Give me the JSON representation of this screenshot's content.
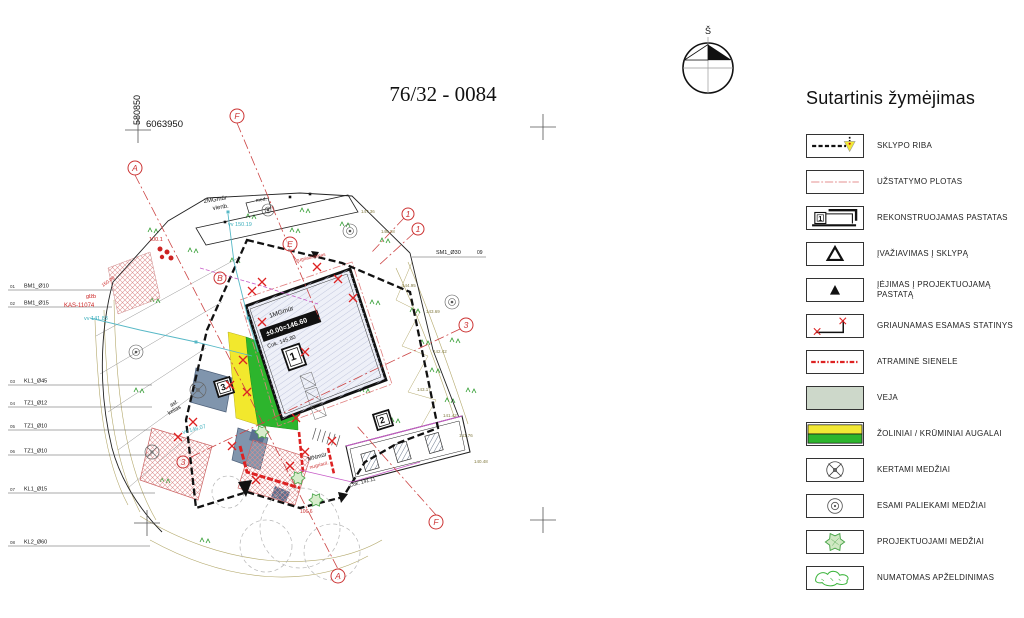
{
  "title": "76/32 - 0084",
  "compass": {
    "label": "Š"
  },
  "legend": {
    "heading": "Sutartinis žymėjimas",
    "items": [
      {
        "label": "SKLYPO RIBA",
        "symbol": "sklypo-riba"
      },
      {
        "label": "UŽSTATYMO PLOTAS",
        "symbol": "uzstatymo-plotas"
      },
      {
        "label": "REKONSTRUOJAMAS PASTATAS",
        "symbol": "rekonstruojamas-pastatas",
        "digit": "1"
      },
      {
        "label": "ĮVAŽIAVIMAS Į SKLYPĄ",
        "symbol": "ivaziavimas-i-sklypa"
      },
      {
        "label": "ĮĖJIMAS Į PROJEKTUOJAMĄ PASTATĄ",
        "symbol": "iejimas-i-pastata"
      },
      {
        "label": "GRIAUNAMAS ESAMAS STATINYS",
        "symbol": "griaunamas-statinys"
      },
      {
        "label": "ATRAMINĖ SIENELE",
        "symbol": "atramine-sienele"
      },
      {
        "label": "VEJA",
        "symbol": "veja"
      },
      {
        "label": "ŽOLINIAI / KRŪMINIAI AUGALAI",
        "symbol": "zoliniai-kruminiai"
      },
      {
        "label": "KERTAMI MEDŽIAI",
        "symbol": "kertami-medziai"
      },
      {
        "label": "ESAMI PALIEKAMI MEDŽIAI",
        "symbol": "esami-paliekami-medziai"
      },
      {
        "label": "PROJEKTUOJAMI MEDŽIAI",
        "symbol": "projektuojami-medziai"
      },
      {
        "label": "NUMATOMAS APŽELDINIMAS",
        "symbol": "numatomas-apzeldinimas"
      }
    ]
  },
  "plan": {
    "callouts": [
      {
        "no": "01",
        "label": "BM1_Ø10",
        "y": 290,
        "x1": 8,
        "x2": 114,
        "nx": 10,
        "lx": 24
      },
      {
        "no": "02",
        "label": "BM1_Ø15",
        "y": 307,
        "x1": 8,
        "x2": 112,
        "nx": 10,
        "lx": 24
      },
      {
        "no": "03",
        "label": "KL1_Ø45",
        "y": 385,
        "x1": 8,
        "x2": 152,
        "nx": 10,
        "lx": 24
      },
      {
        "no": "04",
        "label": "TZ1_Ø12",
        "y": 407,
        "x1": 8,
        "x2": 152,
        "nx": 10,
        "lx": 24
      },
      {
        "no": "05",
        "label": "TZ1_Ø10",
        "y": 430,
        "x1": 8,
        "x2": 152,
        "nx": 10,
        "lx": 24
      },
      {
        "no": "06",
        "label": "TZ1_Ø10",
        "y": 455,
        "x1": 8,
        "x2": 152,
        "nx": 10,
        "lx": 24
      },
      {
        "no": "07",
        "label": "KL1_Ø15",
        "y": 493,
        "x1": 8,
        "x2": 155,
        "nx": 10,
        "lx": 24
      },
      {
        "no": "08",
        "label": "KL2_Ø60",
        "y": 546,
        "x1": 8,
        "x2": 150,
        "nx": 10,
        "lx": 24
      }
    ],
    "labels": [
      {
        "t": "580850",
        "x": 140,
        "y": 110,
        "s": 9,
        "c": "#111",
        "r": -90,
        "a": "middle"
      },
      {
        "t": "6063950",
        "x": 146,
        "y": 127,
        "s": 9.5,
        "c": "#111"
      },
      {
        "t": "SM1_Ø30",
        "x": 436,
        "y": 254,
        "s": 5.5,
        "c": "#111"
      },
      {
        "t": "09",
        "x": 477,
        "y": 254,
        "s": 5,
        "c": "#111"
      },
      {
        "t": "2MGmūr",
        "x": 204,
        "y": 203,
        "s": 6,
        "c": "#111",
        "r": -9
      },
      {
        "t": "vienb.",
        "x": 213,
        "y": 210,
        "s": 6,
        "c": "#111",
        "r": -9
      },
      {
        "t": "med.",
        "x": 256,
        "y": 202,
        "s": 5,
        "c": "#111",
        "r": -9
      },
      {
        "t": "vv 150.19",
        "x": 228,
        "y": 226,
        "s": 5.5,
        "c": "#3aaebc"
      },
      {
        "t": "vv 141.83",
        "x": 84,
        "y": 320,
        "s": 5.5,
        "c": "#3aaebc"
      },
      {
        "t": "vv 146.07",
        "x": 183,
        "y": 434,
        "s": 5.5,
        "c": "#3aaebc",
        "r": -15
      },
      {
        "t": "100.1",
        "x": 149,
        "y": 241,
        "s": 5.5,
        "c": "#c22"
      },
      {
        "t": "KAS-11074",
        "x": 64,
        "y": 307,
        "s": 6,
        "c": "#c22"
      },
      {
        "t": "glžb",
        "x": 86,
        "y": 298,
        "s": 5.5,
        "c": "#c22"
      },
      {
        "t": "150.00",
        "x": 103,
        "y": 287,
        "s": 4.8,
        "c": "#c22",
        "r": -35
      },
      {
        "t": "1MGmūr",
        "x": 270,
        "y": 318,
        "s": 6.5,
        "c": "#111",
        "r": -19
      },
      {
        "t": "±0.00=146.60",
        "x": 267,
        "y": 336,
        "s": 7,
        "c": "#fff",
        "r": -19,
        "w": "bold"
      },
      {
        "t": "Cok. 145.80",
        "x": 268,
        "y": 348,
        "s": 5.5,
        "c": "#111",
        "r": -19
      },
      {
        "t": "nugriaunamas",
        "x": 296,
        "y": 262,
        "s": 4.8,
        "c": "#c33",
        "r": -12
      },
      {
        "t": "MNmūr",
        "x": 308,
        "y": 461,
        "s": 6,
        "c": "#111",
        "r": -15
      },
      {
        "t": "nugriaut.",
        "x": 310,
        "y": 469,
        "s": 5,
        "c": "#c33",
        "r": -15
      },
      {
        "t": "Cok. 141.11",
        "x": 350,
        "y": 487,
        "s": 5,
        "c": "#111",
        "r": -15
      },
      {
        "t": "asf.",
        "x": 171,
        "y": 407,
        "s": 5.5,
        "c": "#111",
        "r": -30
      },
      {
        "t": "kelias",
        "x": 169,
        "y": 415,
        "s": 5.5,
        "c": "#111",
        "r": -30
      },
      {
        "t": "106.6",
        "x": 300,
        "y": 513,
        "s": 5,
        "c": "#c33"
      },
      {
        "t": "1",
        "x": 294,
        "y": 360,
        "s": 11,
        "c": "#111",
        "w": "bold",
        "r": -19,
        "a": "middle"
      },
      {
        "t": "2",
        "x": 383,
        "y": 423,
        "s": 9,
        "c": "#111",
        "w": "bold",
        "r": -17,
        "a": "middle"
      },
      {
        "t": "3",
        "x": 224,
        "y": 390,
        "s": 9,
        "c": "#111",
        "w": "bold",
        "r": -17,
        "a": "middle"
      },
      {
        "t": "148.28",
        "x": 381,
        "y": 233,
        "s": 4.5,
        "c": "#837b42"
      },
      {
        "t": "147.36",
        "x": 361,
        "y": 213,
        "s": 4.5,
        "c": "#837b42"
      },
      {
        "t": "144.95",
        "x": 402,
        "y": 287,
        "s": 4.5,
        "c": "#837b42"
      },
      {
        "t": "143.69",
        "x": 426,
        "y": 313,
        "s": 4.5,
        "c": "#837b42"
      },
      {
        "t": "142.42",
        "x": 433,
        "y": 353,
        "s": 4.5,
        "c": "#837b42"
      },
      {
        "t": "143.17",
        "x": 417,
        "y": 391,
        "s": 4.5,
        "c": "#837b42"
      },
      {
        "t": "141.42",
        "x": 443,
        "y": 417,
        "s": 4.5,
        "c": "#837b42"
      },
      {
        "t": "141.76",
        "x": 459,
        "y": 437,
        "s": 4.5,
        "c": "#837b42"
      },
      {
        "t": "140.48",
        "x": 474,
        "y": 463,
        "s": 4.5,
        "c": "#837b42"
      }
    ],
    "markers": [
      {
        "m": "A",
        "x": 135,
        "y": 168,
        "r": 7
      },
      {
        "m": "F",
        "x": 237,
        "y": 116,
        "r": 7
      },
      {
        "m": "E",
        "x": 290,
        "y": 244,
        "r": 7
      },
      {
        "m": "B",
        "x": 220,
        "y": 278,
        "r": 6
      },
      {
        "m": "1",
        "x": 408,
        "y": 214,
        "r": 6
      },
      {
        "m": "1",
        "x": 418,
        "y": 229,
        "r": 6
      },
      {
        "m": "3",
        "x": 466,
        "y": 325,
        "r": 7
      },
      {
        "m": "3",
        "x": 183,
        "y": 462,
        "r": 6
      },
      {
        "m": "F",
        "x": 436,
        "y": 522,
        "r": 7
      },
      {
        "m": "A",
        "x": 338,
        "y": 576,
        "r": 7
      }
    ]
  }
}
